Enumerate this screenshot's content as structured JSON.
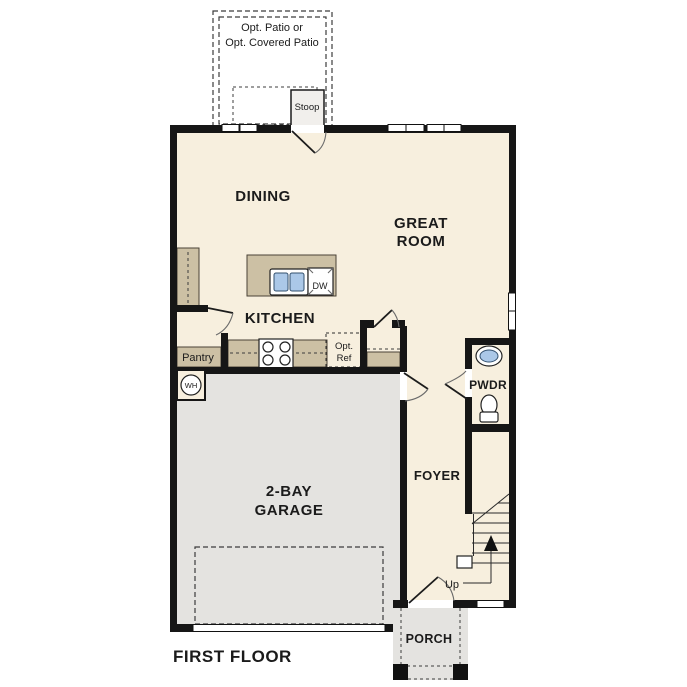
{
  "plan_title": "FIRST FLOOR",
  "colors": {
    "floor": "#f7efde",
    "garage_floor": "#e4e3e0",
    "patio": "#e4e3e0",
    "stoop": "#f1efec",
    "counter": "#ccc0a4",
    "sink": "#abc8e8",
    "wall": "#161616",
    "label_text": "#1b1b1b"
  },
  "rooms": {
    "patio": {
      "label_line1": "Opt. Patio or",
      "label_line2": "Opt. Covered Patio"
    },
    "stoop": {
      "label": "Stoop"
    },
    "dining": {
      "label": "DINING"
    },
    "great_room": {
      "label_line1": "GREAT",
      "label_line2": "ROOM"
    },
    "kitchen": {
      "label": "KITCHEN"
    },
    "pantry": {
      "label": "Pantry"
    },
    "garage": {
      "label_line1": "2-BAY",
      "label_line2": "GARAGE"
    },
    "foyer": {
      "label": "FOYER"
    },
    "powder": {
      "label": "PWDR"
    },
    "porch": {
      "label": "PORCH"
    }
  },
  "fixtures": {
    "dishwasher": "DW",
    "optional_refrigerator_line1": "Opt.",
    "optional_refrigerator_line2": "Ref",
    "water_heater": "WH",
    "stairs_direction": "Up"
  }
}
